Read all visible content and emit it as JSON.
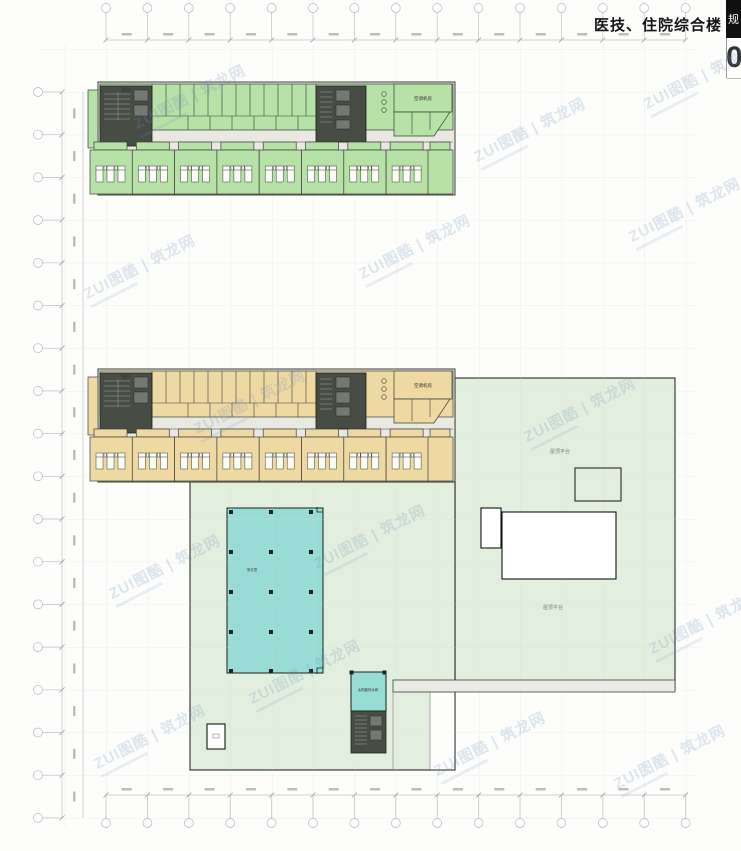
{
  "header": {
    "title": "医技、住院综合楼",
    "titleblock": {
      "top_char": "规",
      "bottom_char": "0"
    }
  },
  "watermark": {
    "line1": "ZUI图酷 | 筑龙网"
  },
  "plan_labels": {
    "balcony": "阳台",
    "ac_room": "空调机房"
  },
  "site_labels": {
    "roof_terrace_upper": "屋顶平台",
    "roof_terrace_lower": "屋顶平台",
    "skylight": "采光顶",
    "solar_room": "太阳能热水间"
  },
  "colors": {
    "floor_upper_fill": "#b6e1a7",
    "floor_lower_fill": "#eed9a2",
    "roof_fill": "#e3efde",
    "skylight_fill": "#98dcd6",
    "core_fill": "#474c44",
    "corridor_fill": "#e9e9e2",
    "watermark_color": "#6e91b9"
  }
}
